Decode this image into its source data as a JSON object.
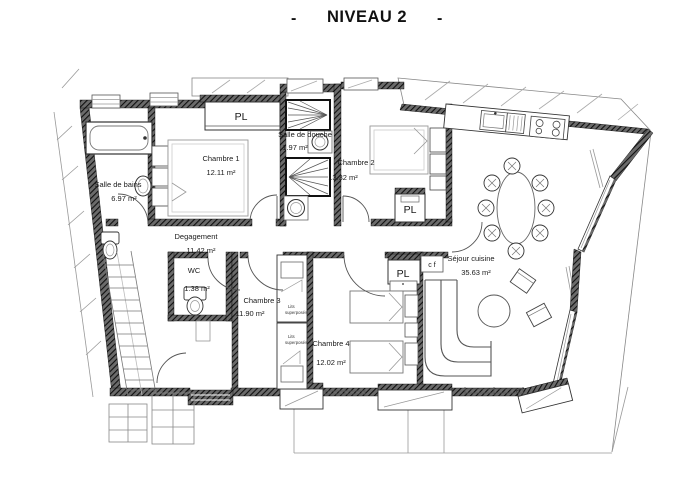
{
  "title": {
    "dash_left": "-",
    "text": "NIVEAU 2",
    "dash_right": "-"
  },
  "rooms": {
    "salle_de_bains": {
      "name": "Salle de bains",
      "area": "6.97 m²"
    },
    "chambre1": {
      "name": "Chambre 1",
      "area": "12.11 m²"
    },
    "salle_de_douche": {
      "name": "Salle de douche",
      "area": "1.97 m²"
    },
    "chambre2": {
      "name": "Chambre 2",
      "area": "13.32 m²"
    },
    "degagement": {
      "name": "Degagement",
      "area": "11.42 m²"
    },
    "wc": {
      "name": "WC",
      "area": "1.38 m²"
    },
    "chambre3": {
      "name": "Chambre 3",
      "area": "11.90 m²"
    },
    "chambre4": {
      "name": "Chambre 4",
      "area": "12.02 m²"
    },
    "sejour": {
      "name": "Séjour cuisine",
      "area": "35.63 m²"
    }
  },
  "closets": {
    "pl_top": "PL",
    "pl_mid": "PL",
    "pl_low": "PL",
    "cf": "c f"
  },
  "annotations": {
    "bunk_upper": {
      "line1": "Lits",
      "line2": "superposés"
    },
    "bunk_lower": {
      "line1": "Lits",
      "line2": "superposés"
    }
  },
  "colors": {
    "ink": "#1a1a1a",
    "wall_dark": "#2b2b2b",
    "furniture": "#555555",
    "light_line": "#999999",
    "background": "#ffffff"
  }
}
